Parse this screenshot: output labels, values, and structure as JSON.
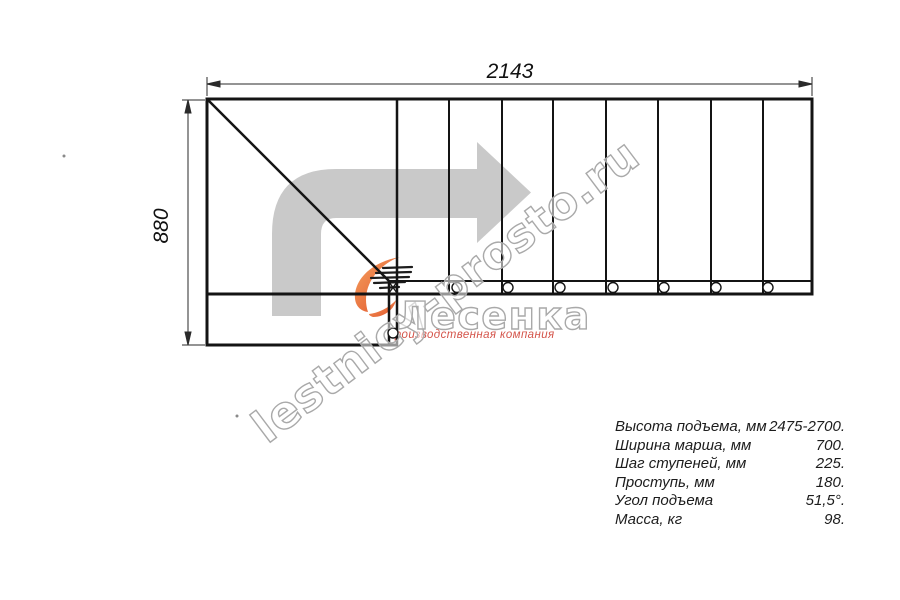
{
  "drawing": {
    "top_dimension": "2143",
    "left_dimension": "880"
  },
  "watermark": {
    "site": "lestnicy-prosto.ru",
    "logo_text": "Лесенка",
    "tagline": "производственная компания"
  },
  "specs": {
    "rows": [
      {
        "label": "Высота подъема, мм",
        "value": "2475-2700."
      },
      {
        "label": "Ширина марша, мм",
        "value": "700."
      },
      {
        "label": "Шаг ступеней, мм",
        "value": "225."
      },
      {
        "label": "Проступь, мм",
        "value": "180."
      },
      {
        "label": "Угол подъема",
        "value": "51,5°."
      },
      {
        "label": "Масса, кг",
        "value": "98."
      }
    ]
  },
  "colors": {
    "line": "#141414",
    "arrow_gray": "#c9c9c9",
    "watermark_gray": "#a9a9a9",
    "tagline_red": "#d4544a",
    "flame_orange_light": "#f5a15f",
    "flame_orange_dark": "#e04f28"
  }
}
